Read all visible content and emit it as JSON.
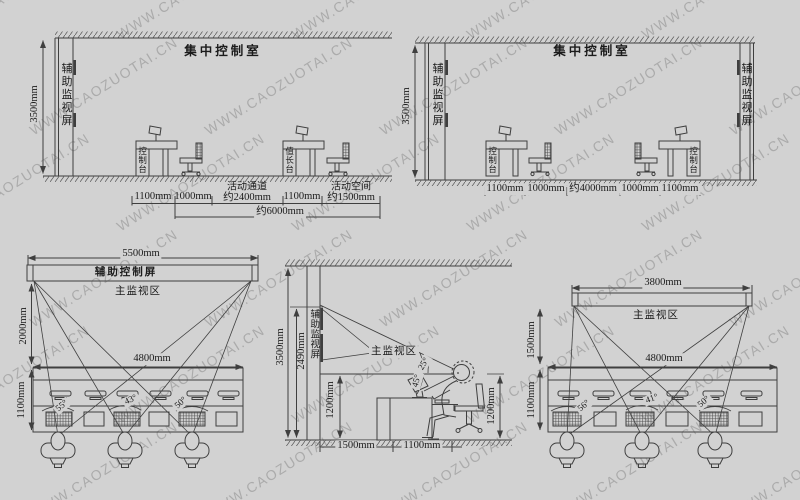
{
  "watermark": {
    "text": "WWW.CAOZUOTAI.CN"
  },
  "colors": {
    "background": "#d2d2d2",
    "line": "#3f3f3f",
    "text": "#1b1b1b"
  },
  "diagrams": {
    "top_left": {
      "title": "集中控制室",
      "height_dim": "3500mm",
      "screen_label": "辅助监视屏",
      "console_label": "控制台",
      "chief_label": "值长台",
      "dim1": "1100mm",
      "dim2": "1000mm",
      "passage_label": "活动通道",
      "passage_dim": "约2400mm",
      "dim3": "1100mm",
      "space_label": "活动空间",
      "space_dim": "约1500mm",
      "total_dim": "约6000mm"
    },
    "top_right": {
      "title": "集中控制室",
      "height_dim": "3500mm",
      "screen_left": "辅助监视屏",
      "screen_right": "辅助监视屏",
      "console_left": "控制台",
      "console_right": "控制台",
      "dim1": "1100mm",
      "dim2": "1000mm",
      "dim3": "约4000mm",
      "dim4": "1000mm",
      "dim5": "1100mm"
    },
    "bottom_left": {
      "top_dim": "5500mm",
      "bar_label": "辅助控制屏",
      "area_label": "主监视区",
      "left_dim": "2000mm",
      "mid_dim": "4800mm",
      "console_dim": "1100mm",
      "angle1": "55°",
      "angle2": "43°",
      "angle3": "50°"
    },
    "bottom_middle": {
      "wall_dim": "3500mm",
      "screen_dim": "2490mm",
      "screen_label": "辅助监视屏",
      "area_label": "主监视区",
      "angle_upper": "25°",
      "angle_lower": "45°",
      "console_height": "1200mm",
      "eye_height": "1200mm",
      "floor_dim1": "1500mm",
      "floor_dim2": "1100mm"
    },
    "bottom_right": {
      "top_dim": "3800mm",
      "area_label": "主监视区",
      "left_dim": "1500mm",
      "mid_dim": "4800mm",
      "console_dim": "1100mm",
      "angle1": "56°",
      "angle2": "41°",
      "angle3": "50°"
    }
  }
}
